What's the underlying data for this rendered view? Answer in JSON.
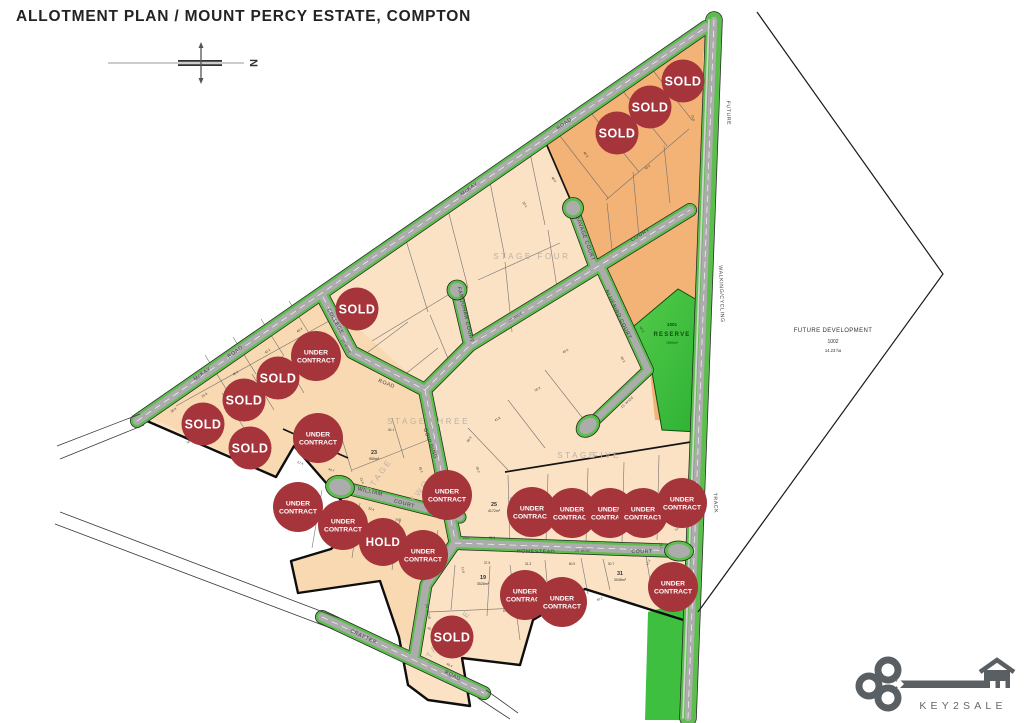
{
  "title": "ALLOTMENT PLAN / MOUNT PERCY ESTATE, COMPTON",
  "compass": {
    "north": "N"
  },
  "colors": {
    "badge_red": "#A5343B",
    "road_green": "#5CBE4C",
    "road_grey": "#ACACAC",
    "reserve_green": "#3FBF3F",
    "lot_peach": "#FBE2C4",
    "lot_orange": "#F3B377"
  },
  "badge_text": {
    "sold": "SOLD",
    "hold": "HOLD",
    "under_contract_line1": "UNDER",
    "under_contract_line2": "CONTRACT"
  },
  "logo": {
    "text": "KEY2SALE"
  },
  "map": {
    "stage_labels": [
      {
        "t": "STAGE",
        "x": 513,
        "y": 259,
        "r": 0
      },
      {
        "t": "FOUR",
        "x": 554,
        "y": 259,
        "r": 0
      },
      {
        "t": "STAGE",
        "x": 407,
        "y": 424,
        "r": 0
      },
      {
        "t": "THREE",
        "x": 450,
        "y": 424,
        "r": 0
      },
      {
        "t": "STAGE",
        "x": 381,
        "y": 477,
        "r": -55
      },
      {
        "t": "TWO",
        "x": 422,
        "y": 492,
        "r": -55
      },
      {
        "t": "STAGE",
        "x": 577,
        "y": 458,
        "r": 0
      },
      {
        "t": "FIVE",
        "x": 607,
        "y": 458,
        "r": 0
      },
      {
        "t": "STAGE",
        "x": 437,
        "y": 649,
        "r": -55
      },
      {
        "t": "ONE",
        "x": 464,
        "y": 622,
        "r": -55
      }
    ],
    "road_labels": [
      {
        "t": "McKAY",
        "x": 203,
        "y": 375,
        "r": -35
      },
      {
        "t": "ROAD",
        "x": 236,
        "y": 353,
        "r": -35
      },
      {
        "t": "McKAY",
        "x": 470,
        "y": 190,
        "r": -35
      },
      {
        "t": "ROAD",
        "x": 565,
        "y": 125,
        "r": -35
      },
      {
        "t": "COLLEGE",
        "x": 334,
        "y": 322,
        "r": 60
      },
      {
        "t": "20 WIDE",
        "x": 345,
        "y": 347,
        "r": 60,
        "s": 1
      },
      {
        "t": "ROAD",
        "x": 386,
        "y": 385,
        "r": 22
      },
      {
        "t": "20 WIDE",
        "x": 516,
        "y": 318,
        "r": -31,
        "s": 1
      },
      {
        "t": "COURT",
        "x": 641,
        "y": 236,
        "r": -32
      },
      {
        "t": "SAVAGE COURT",
        "x": 584,
        "y": 239,
        "r": 70
      },
      {
        "t": "FARQUHAR COURT",
        "x": 464,
        "y": 315,
        "r": 77
      },
      {
        "t": "BLUEBIRD COURT",
        "x": 617,
        "y": 315,
        "r": 64
      },
      {
        "t": "15 WIDE",
        "x": 628,
        "y": 403,
        "r": -42,
        "s": 1
      },
      {
        "t": "GOULDING",
        "x": 429,
        "y": 444,
        "r": 70
      },
      {
        "t": "WILLIAM",
        "x": 370,
        "y": 493,
        "r": 13
      },
      {
        "t": "COURT",
        "x": 404,
        "y": 505,
        "r": 15
      },
      {
        "t": "25 WIDE",
        "x": 434,
        "y": 516,
        "r": 17,
        "s": 1
      },
      {
        "t": "HOMESTEAD",
        "x": 536,
        "y": 553,
        "r": 1
      },
      {
        "t": "20 WIDE",
        "x": 583,
        "y": 552,
        "r": 1,
        "s": 1
      },
      {
        "t": "COURT",
        "x": 642,
        "y": 553,
        "r": 1
      },
      {
        "t": "20 WIDE",
        "x": 427,
        "y": 612,
        "r": 78,
        "s": 1
      },
      {
        "t": "CRAFTER",
        "x": 363,
        "y": 638,
        "r": 25
      },
      {
        "t": "ROAD",
        "x": 452,
        "y": 677,
        "r": 25
      },
      {
        "t": "FUTURE",
        "x": 727,
        "y": 113,
        "r": 88
      },
      {
        "t": "WALKING/CYCLING",
        "x": 720,
        "y": 294,
        "r": 88
      },
      {
        "t": "TRACK",
        "x": 714,
        "y": 503,
        "r": 87
      }
    ],
    "badges": [
      {
        "type": "sold",
        "x": 683,
        "y": 81
      },
      {
        "type": "sold",
        "x": 650,
        "y": 107
      },
      {
        "type": "sold",
        "x": 617,
        "y": 133
      },
      {
        "type": "sold",
        "x": 357,
        "y": 309
      },
      {
        "type": "uc",
        "x": 316,
        "y": 356
      },
      {
        "type": "sold",
        "x": 278,
        "y": 378
      },
      {
        "type": "sold",
        "x": 244,
        "y": 400
      },
      {
        "type": "sold",
        "x": 203,
        "y": 424
      },
      {
        "type": "sold",
        "x": 250,
        "y": 448
      },
      {
        "type": "uc",
        "x": 318,
        "y": 438
      },
      {
        "type": "uc",
        "x": 298,
        "y": 507
      },
      {
        "type": "uc",
        "x": 343,
        "y": 525
      },
      {
        "type": "hold",
        "x": 383,
        "y": 542
      },
      {
        "type": "uc",
        "x": 423,
        "y": 555
      },
      {
        "type": "uc",
        "x": 447,
        "y": 495
      },
      {
        "type": "uc",
        "x": 532,
        "y": 512
      },
      {
        "type": "uc",
        "x": 572,
        "y": 513
      },
      {
        "type": "uc",
        "x": 610,
        "y": 513
      },
      {
        "type": "uc",
        "x": 643,
        "y": 513
      },
      {
        "type": "uc",
        "x": 682,
        "y": 503
      },
      {
        "type": "uc",
        "x": 525,
        "y": 595
      },
      {
        "type": "uc",
        "x": 562,
        "y": 602
      },
      {
        "type": "uc",
        "x": 673,
        "y": 587
      },
      {
        "type": "sold",
        "x": 452,
        "y": 637
      }
    ],
    "lots": [
      {
        "number": "23",
        "area": "900m²",
        "x": 374,
        "y": 456
      },
      {
        "number": "25",
        "area": "4172m²",
        "x": 494,
        "y": 508
      },
      {
        "number": "19",
        "area": "3528m²",
        "x": 483,
        "y": 581
      },
      {
        "number": "31",
        "area": "3045m²",
        "x": 620,
        "y": 577
      }
    ],
    "reserve": {
      "number": "1001",
      "name": "RESERVE",
      "area": "7890m²",
      "x": 672,
      "y": 334
    },
    "future_development": {
      "line1": "FUTURE DEVELOPMENT",
      "lot": "1002",
      "area": "14.23 ha",
      "x": 833,
      "y": 332
    },
    "dimensions": [
      {
        "v": "21.8",
        "x": 692,
        "y": 118,
        "r": 80
      },
      {
        "v": "50.9",
        "x": 648,
        "y": 168,
        "r": -35
      },
      {
        "v": "42.0",
        "x": 612,
        "y": 130,
        "r": 55
      },
      {
        "v": "40.3",
        "x": 585,
        "y": 155,
        "r": 55
      },
      {
        "v": "48.0",
        "x": 553,
        "y": 180,
        "r": 55
      },
      {
        "v": "30.1",
        "x": 524,
        "y": 205,
        "r": 55
      },
      {
        "v": "41.1",
        "x": 341,
        "y": 320,
        "r": 42
      },
      {
        "v": "40.3",
        "x": 300,
        "y": 331,
        "r": -35
      },
      {
        "v": "42.2",
        "x": 268,
        "y": 352,
        "r": -35
      },
      {
        "v": "46.2",
        "x": 236,
        "y": 374,
        "r": -35
      },
      {
        "v": "25.8",
        "x": 205,
        "y": 396,
        "r": -35
      },
      {
        "v": "36.8",
        "x": 174,
        "y": 411,
        "r": -35
      },
      {
        "v": "50.8",
        "x": 190,
        "y": 442,
        "r": -35
      },
      {
        "v": "27.4",
        "x": 300,
        "y": 464,
        "r": 18
      },
      {
        "v": "44.7",
        "x": 331,
        "y": 471,
        "r": 18
      },
      {
        "v": "21.4",
        "x": 361,
        "y": 481,
        "r": 70
      },
      {
        "v": "40.1",
        "x": 391,
        "y": 431,
        "r": 0
      },
      {
        "v": "45.1",
        "x": 420,
        "y": 470,
        "r": 70
      },
      {
        "v": "25.2",
        "x": 452,
        "y": 500,
        "r": 70
      },
      {
        "v": "32.4",
        "x": 371,
        "y": 510,
        "r": 14
      },
      {
        "v": "26.3",
        "x": 398,
        "y": 521,
        "r": 14
      },
      {
        "v": "90.9",
        "x": 470,
        "y": 440,
        "r": -55
      },
      {
        "v": "60.2",
        "x": 477,
        "y": 470,
        "r": 70
      },
      {
        "v": "41.8",
        "x": 498,
        "y": 420,
        "r": -30
      },
      {
        "v": "50.3",
        "x": 538,
        "y": 390,
        "r": -30
      },
      {
        "v": "40.0",
        "x": 566,
        "y": 352,
        "r": -30
      },
      {
        "v": "60.3",
        "x": 641,
        "y": 330,
        "r": 62
      },
      {
        "v": "80.2",
        "x": 622,
        "y": 360,
        "r": 62
      },
      {
        "v": "16.5",
        "x": 466,
        "y": 539,
        "r": 0
      },
      {
        "v": "30.0",
        "x": 492,
        "y": 539,
        "r": 0
      },
      {
        "v": "44.3",
        "x": 528,
        "y": 537,
        "r": 0
      },
      {
        "v": "47.3",
        "x": 573,
        "y": 535,
        "r": 0
      },
      {
        "v": "47.3",
        "x": 616,
        "y": 534,
        "r": 0
      },
      {
        "v": "35.07",
        "x": 650,
        "y": 533,
        "r": 0
      },
      {
        "v": "12.2",
        "x": 678,
        "y": 529,
        "r": -40
      },
      {
        "v": "11.8",
        "x": 462,
        "y": 570,
        "r": 80
      },
      {
        "v": "37.5",
        "x": 487,
        "y": 564,
        "r": 0
      },
      {
        "v": "31.3",
        "x": 528,
        "y": 565,
        "r": 0
      },
      {
        "v": "60.9",
        "x": 572,
        "y": 565,
        "r": 0
      },
      {
        "v": "30.7",
        "x": 611,
        "y": 565,
        "r": 0
      },
      {
        "v": "17.2",
        "x": 649,
        "y": 563,
        "r": -60
      },
      {
        "v": "70.5",
        "x": 510,
        "y": 500,
        "r": 80
      },
      {
        "v": "19.5",
        "x": 528,
        "y": 498,
        "r": 80
      },
      {
        "v": "45.0",
        "x": 430,
        "y": 630,
        "r": 25
      },
      {
        "v": "40.4",
        "x": 449,
        "y": 666,
        "r": 25
      },
      {
        "v": "57.0",
        "x": 506,
        "y": 612,
        "r": 0
      },
      {
        "v": "40.2",
        "x": 600,
        "y": 600,
        "r": -22
      },
      {
        "v": "31.1",
        "x": 660,
        "y": 546,
        "r": 80
      }
    ]
  }
}
